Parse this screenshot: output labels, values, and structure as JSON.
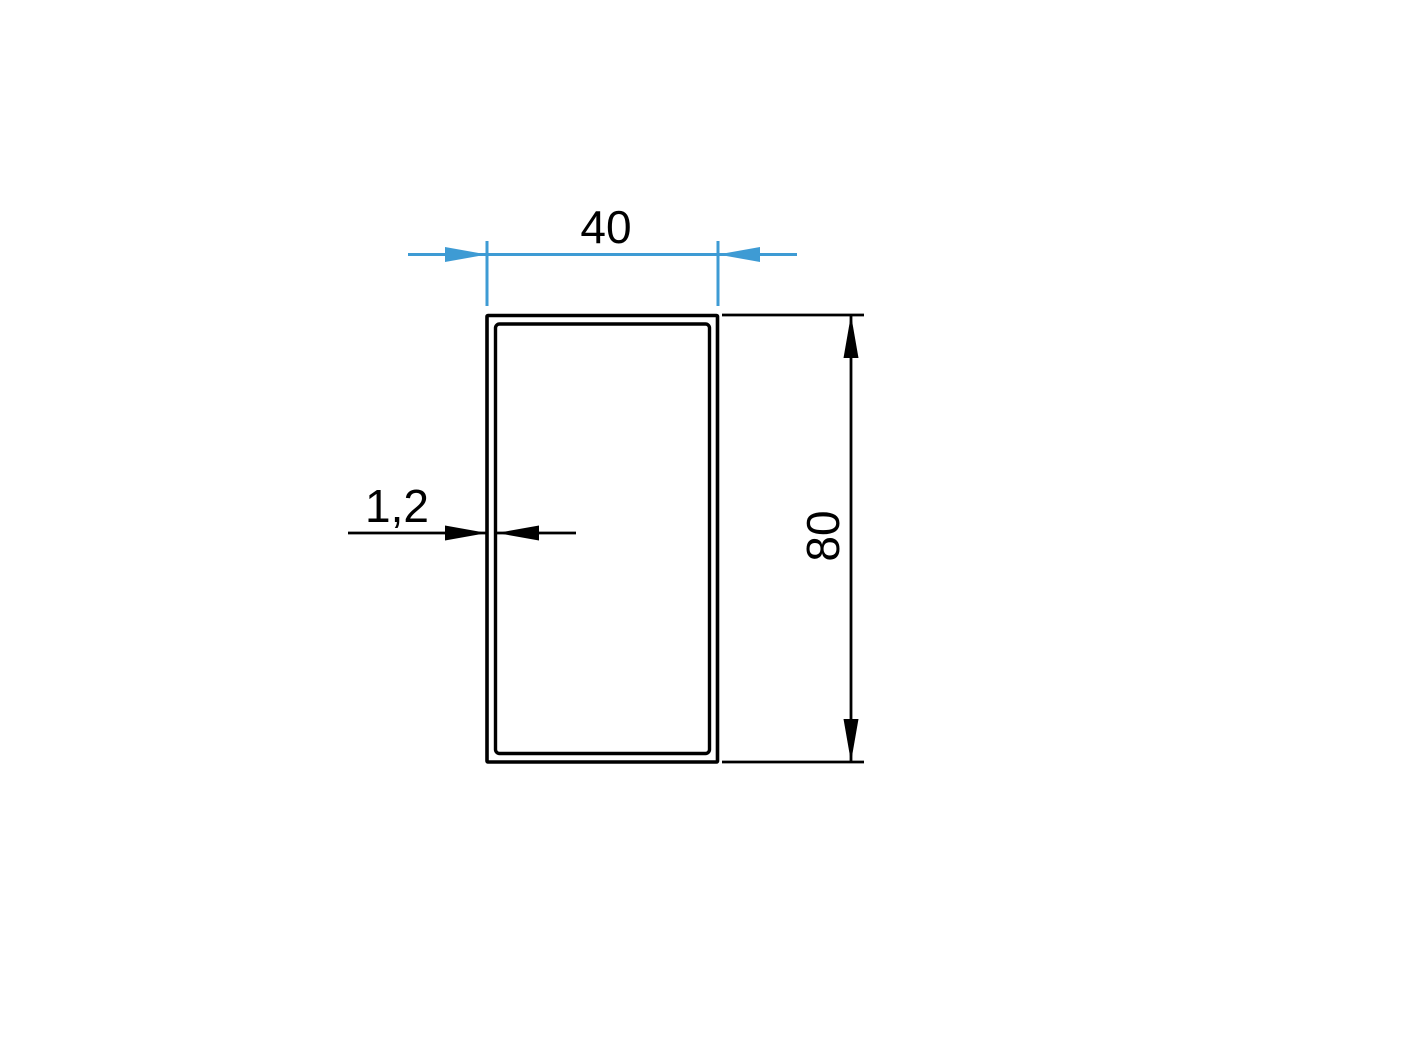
{
  "drawing": {
    "background_color": "#ffffff",
    "outline_color": "#000000",
    "accent_color": "#3e9bd4",
    "dimensions": {
      "width": "40",
      "height": "80",
      "wall_thickness": "1,2"
    }
  }
}
